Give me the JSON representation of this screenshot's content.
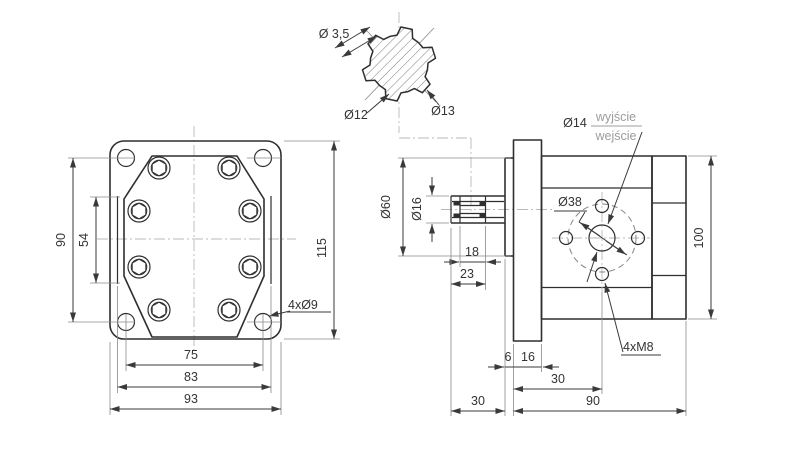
{
  "drawing": {
    "type": "technical-drawing-gear-pump",
    "colors": {
      "line": "#2f2f2f",
      "dimension": "#3a3a3a",
      "centerline": "#b9b9b9",
      "muted_text": "#9c9c9c",
      "background": "#ffffff"
    },
    "spline_section": {
      "pin_dia": "Ø 3,5",
      "root_dia": "Ø12",
      "tip_dia": "Ø13"
    },
    "front_view": {
      "hole_spacing_v": "90",
      "body_height": "54",
      "flange_height": "115",
      "hole_spacing_h": "75",
      "body_width": "83",
      "flange_width": "93",
      "corner_holes": "4xØ9"
    },
    "side_view": {
      "spigot_dia": "Ø60",
      "shaft_dia": "Ø16",
      "spline_len": "18",
      "shaft_len_part": "23",
      "port_dia": "Ø14",
      "port_out": "wyjście",
      "port_in": "wejście",
      "bolt_circle": "Ø38",
      "mount_thread": "4xM8",
      "body_height": "100",
      "spigot_thick": "6",
      "flange_thick": "16",
      "port_offset": "30",
      "shaft_proj": "30",
      "body_length": "90"
    }
  }
}
